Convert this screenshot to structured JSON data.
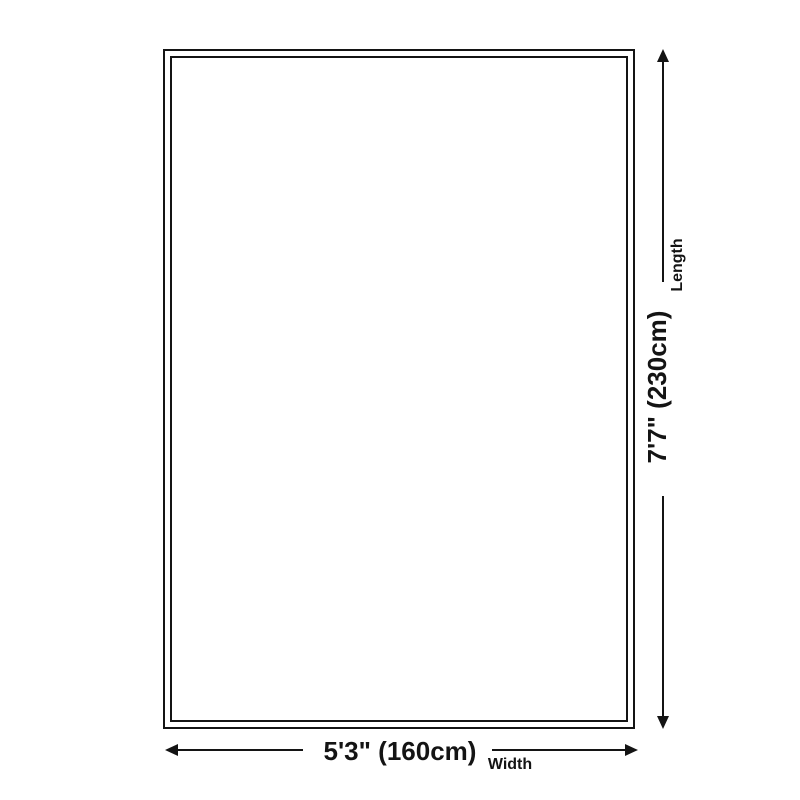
{
  "diagram": {
    "type": "product-dimension-diagram",
    "length": {
      "value": "7'7\" (230cm)",
      "label": "Length"
    },
    "width": {
      "value": "5'3\" (160cm)",
      "label": "Width"
    },
    "colors": {
      "line": "#141414",
      "text": "#141414",
      "background": "#ffffff",
      "rug_fill": "#ffffff"
    }
  }
}
